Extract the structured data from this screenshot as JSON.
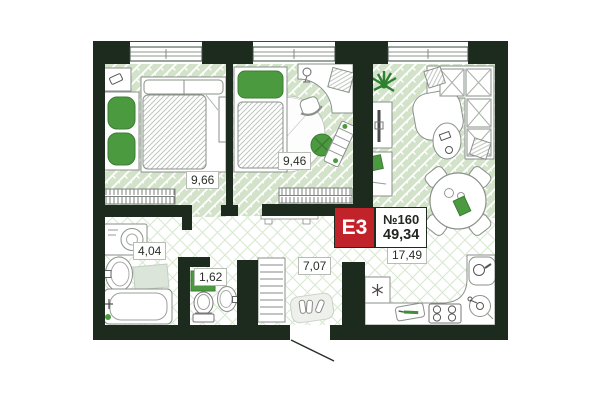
{
  "floor_plan": {
    "badge": {
      "type_label": "E3",
      "unit_number": "№160",
      "total_area": "49,34"
    },
    "rooms": [
      {
        "name": "bedroom-1",
        "area": "9,66"
      },
      {
        "name": "bedroom-2",
        "area": "9,46"
      },
      {
        "name": "bathroom",
        "area": "4,04"
      },
      {
        "name": "toilet",
        "area": "1,62"
      },
      {
        "name": "hallway",
        "area": "7,07"
      },
      {
        "name": "kitchen-living-room",
        "area": "17,49"
      }
    ],
    "colors": {
      "walls": "#1d2a1e",
      "parquet_green": "#d3e3c9",
      "tile_line_green": "#d8e8cf",
      "accent_green": "#4c9a40",
      "badge_red": "#c1232b"
    }
  }
}
